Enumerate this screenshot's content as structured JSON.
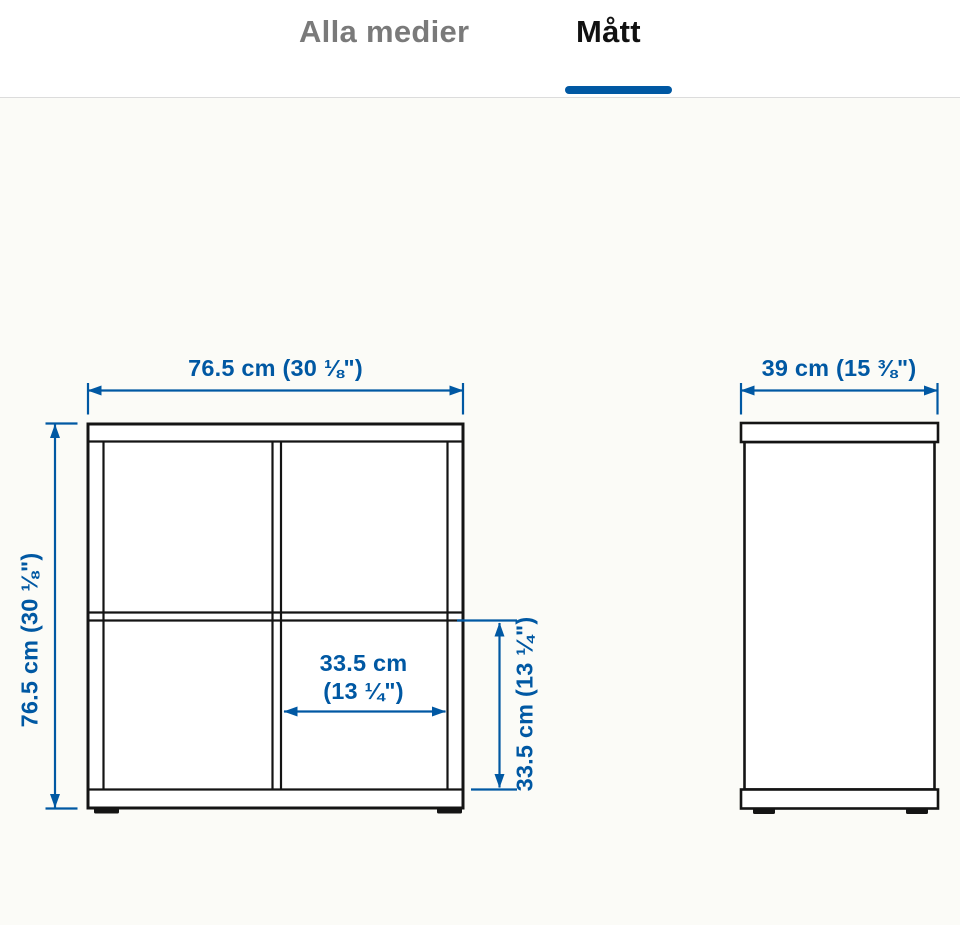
{
  "tabs": [
    {
      "label": "Alla medier",
      "active": false
    },
    {
      "label": "Mått",
      "active": true
    }
  ],
  "diagram": {
    "front_view": {
      "width_label": "76.5 cm (30 ⅛\")",
      "height_label": "76.5 cm (30 ⅛\")",
      "inner_width_label_line1": "33.5 cm",
      "inner_width_label_line2": "(13 ¼\")",
      "inner_height_label": "33.5 cm (13 ¼\")"
    },
    "side_view": {
      "depth_label": "39 cm (15 ⅜\")"
    },
    "colors": {
      "dimension_blue": "#0058a3",
      "drawing_line_black": "#141414",
      "canvas_background": "#fbfbf7",
      "active_tab_text": "#111111",
      "inactive_tab_text": "#7a7a7a",
      "tab_underline": "#0058a3",
      "tabbar_divider": "#dcdcdc"
    }
  }
}
